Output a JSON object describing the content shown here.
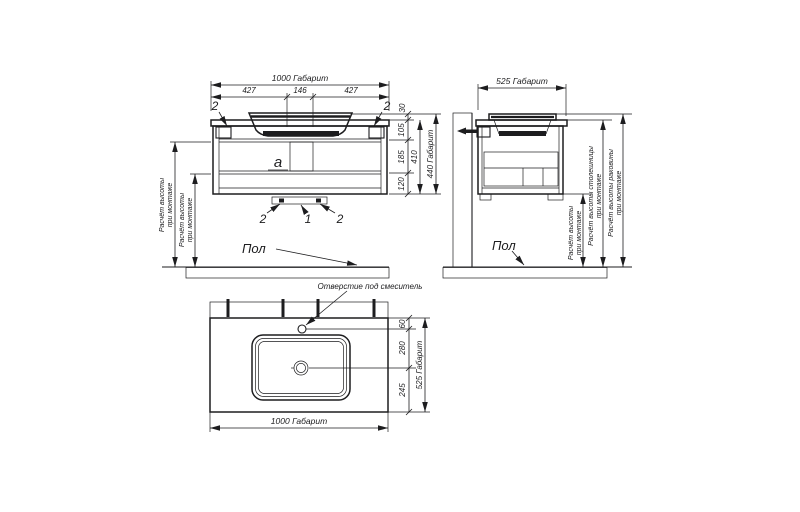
{
  "colors": {
    "line": "#1d1d1f",
    "background": "#ffffff"
  },
  "front_view": {
    "dim_width_overall": "1000 Габарит",
    "dim_segments": [
      "427",
      "146",
      "427"
    ],
    "dim_heights": [
      "30",
      "105",
      "185",
      "120"
    ],
    "dim_height_sub": "410",
    "dim_height_overall": "440 Габарит",
    "callout_bracket_left": "2",
    "callout_bracket_right": "2",
    "callout_bottom_left": "2",
    "callout_bottom_center": "1",
    "callout_bottom_right": "2",
    "section_label": "a",
    "floor_label": "Пол",
    "mount_height_1": {
      "line1": "Расчёт высоты",
      "line2": "при монтаже"
    },
    "mount_height_2": {
      "line1": "Расчёт высоты",
      "line2": "при монтаже"
    }
  },
  "side_view": {
    "dim_depth_overall": "525 Габарит",
    "floor_label": "Пол",
    "mount_height": {
      "line1": "Расчёт высоты",
      "line2": "при монтаже"
    },
    "countertop_height": {
      "line1": "Расчёт высоты столешницы",
      "line2": "при монтаже"
    },
    "sink_height": {
      "line1": "Расчёт высоты раковины",
      "line2": "при монтаже"
    }
  },
  "plan_view": {
    "mixer_hole_label": "Отверстие под смеситель",
    "dim_depths": [
      "60",
      "280",
      "245"
    ],
    "dim_depth_overall": "525 Габарит",
    "dim_width_overall": "1000 Габарит"
  }
}
